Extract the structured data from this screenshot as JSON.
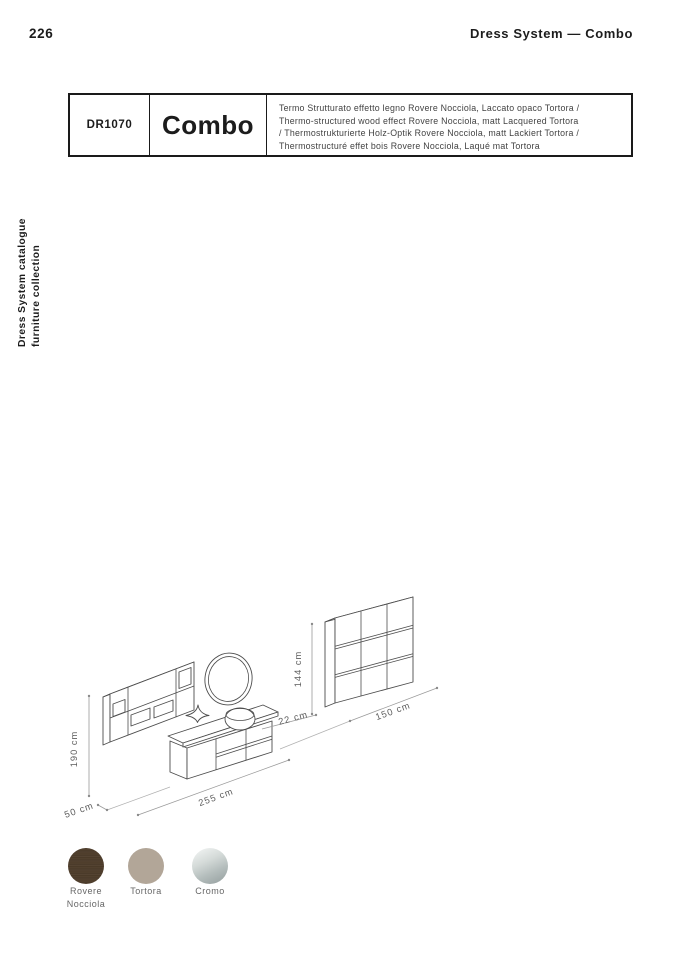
{
  "page": {
    "number": "226",
    "header_right": "Dress System — Combo"
  },
  "sidebar_vertical": {
    "line1": "Dress System catalogue",
    "line2": "furniture collection"
  },
  "product_table": {
    "code": "DR1070",
    "name": "Combo",
    "description_lines": [
      "Termo Strutturato effetto legno Rovere Nocciola, Laccato opaco Tortora /",
      "Thermo-structured wood effect Rovere Nocciola, matt Lacquered Tortora",
      "/ Thermostrukturierte Holz-Optik Rovere Nocciola, matt Lackiert Tortora /",
      "Thermostructuré effet bois Rovere Nocciola, Laqué mat Tortora"
    ]
  },
  "diagram": {
    "dim_height_composition": "190 cm",
    "dim_depth_floor": "50 cm",
    "dim_width_vanity_row": "255 cm",
    "dim_depth_cabinet": "22 cm",
    "dim_height_cabinet": "144 cm",
    "dim_width_cabinet": "150 cm"
  },
  "swatches": [
    {
      "name": "Rovere Nocciola",
      "color": "#4d3c2b",
      "finish": "wood"
    },
    {
      "name": "Tortora",
      "color": "#b2a698",
      "finish": "matt"
    },
    {
      "name": "Cromo",
      "color": "#c2cac9",
      "finish": "chrome"
    }
  ],
  "colors": {
    "text_dark": "#1c1c1c",
    "text_gray": "#424242",
    "line_furniture": "#4d4d4d",
    "line_dimension": "#9a9a9a"
  }
}
